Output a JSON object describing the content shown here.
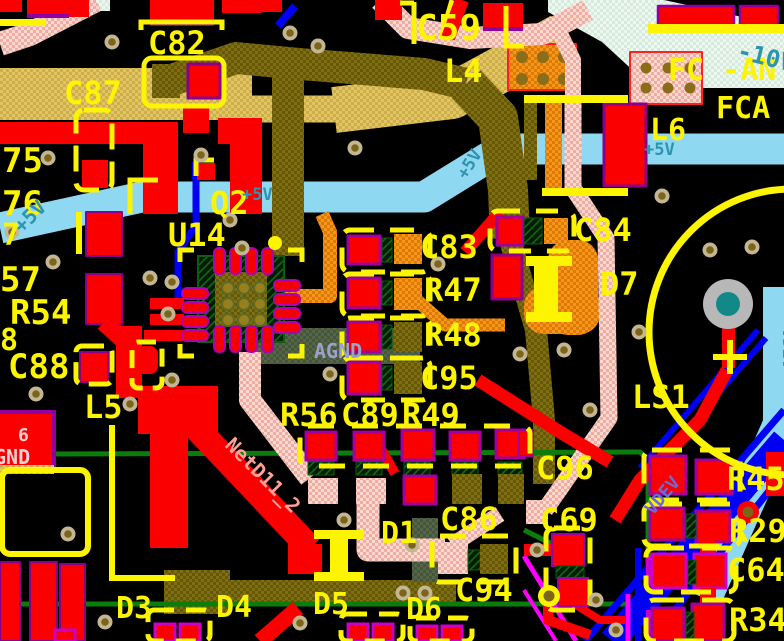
{
  "view": {
    "type": "pcb-layout-editor-canvas",
    "description": "Zoomed PCB layout view with copper, silkscreen and net labels"
  },
  "colors": {
    "silkscreen": "#fcf400",
    "top_copper": "#fa0000",
    "pad_outline": "#a000a0",
    "power_trace_blue": "#8fd8f2",
    "net_label_teal": "#2f93ae",
    "pour_tan": "#d9bd5e",
    "trace_olive": "#7b6c12",
    "trace_orange": "#f28a10",
    "trace_pink": "#f4bcb0",
    "trace_green": "#0a7d0a",
    "trace_blue": "#0000f5",
    "trace_magenta": "#ff00ff",
    "region_mint": "#e2f0e6",
    "via_ring": "#c2b694",
    "via_hole": "#7c6418"
  },
  "designators": {
    "c82": "C82",
    "c87": "C87",
    "c59": "C59",
    "l4": "L4",
    "l6": "L6",
    "n75": "75",
    "n76": "76",
    "n7": "7",
    "n57": "57",
    "r54": "R54",
    "n8": "8",
    "c88": "C88",
    "l5": "L5",
    "u14": "U14",
    "q2": "Q2",
    "c83": "C83",
    "r47": "R47",
    "r48": "R48",
    "c95": "C95",
    "c84": "C84",
    "d7": "D7",
    "r56": "R56",
    "c89": "C89",
    "r49": "R49",
    "ls1": "LS1",
    "c96": "C96",
    "c69": "C69",
    "c86": "C86",
    "c94": "C94",
    "d1": "D1",
    "d3": "D3",
    "d4": "D4",
    "d5": "D5",
    "d6": "D6",
    "r45": "R45",
    "r29": "R29",
    "c64": "C64",
    "r34": "R34"
  },
  "nets": {
    "plus5v": "+5V",
    "agnd": "AGND",
    "vdev": "VDEV",
    "minus10v": "-10V",
    "netd11": "NetD11_2",
    "fc_an": "FC -AN",
    "fca": "FCA",
    "gnd": "GND",
    "pin6": "6"
  }
}
